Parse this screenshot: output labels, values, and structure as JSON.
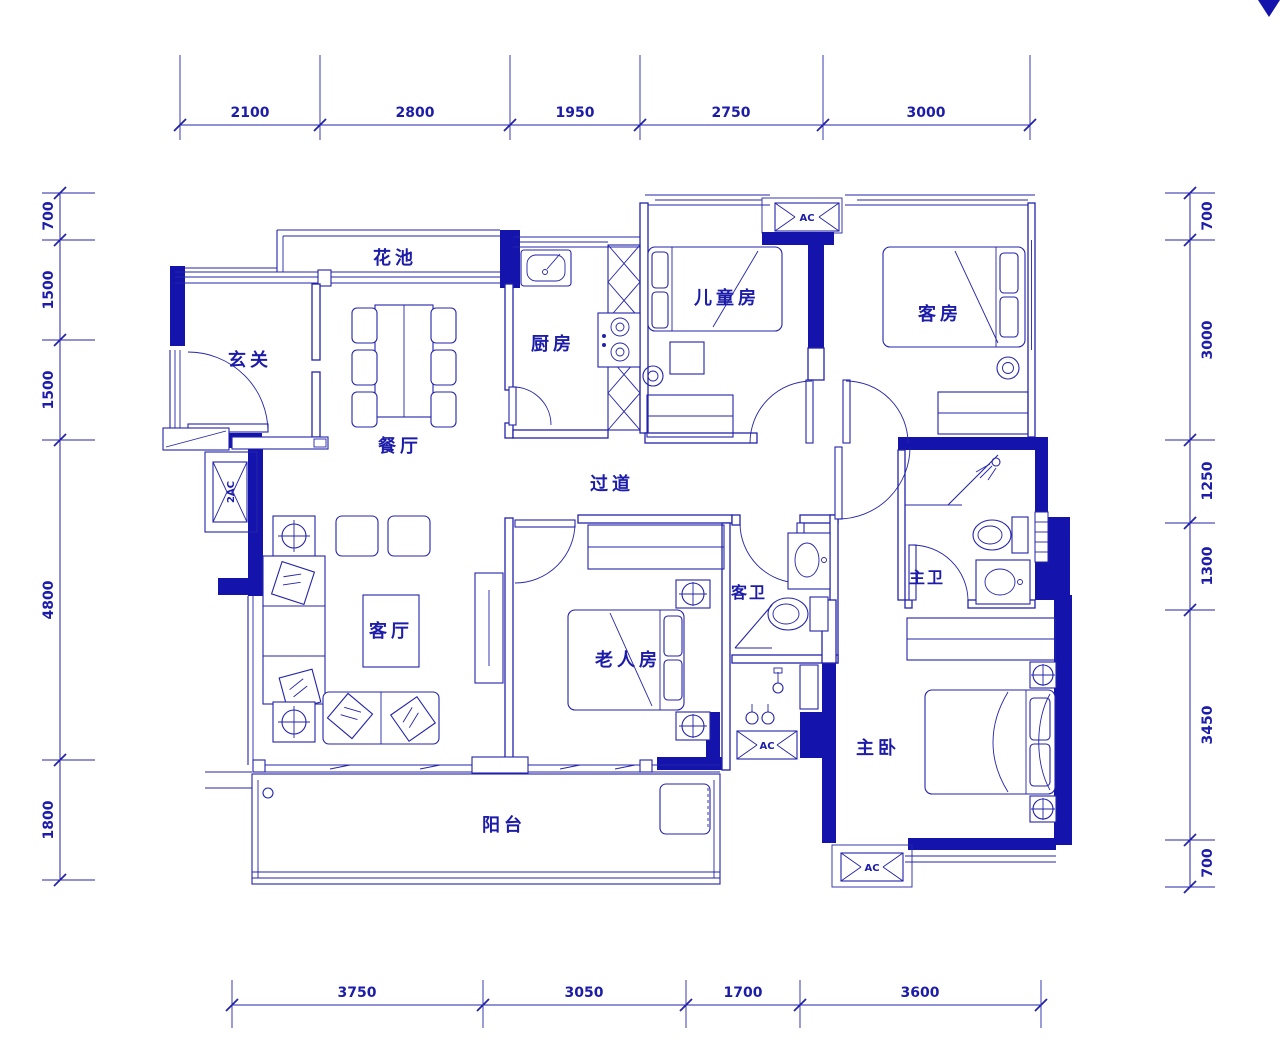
{
  "colors": {
    "line_blue": "#2323aa",
    "wall_fill": "#1414ac",
    "background": "#ffffff"
  },
  "rooms": {
    "flower_bed": {
      "label": "花池"
    },
    "foyer": {
      "label": "玄关"
    },
    "dining": {
      "label": "餐厅"
    },
    "kitchen": {
      "label": "厨房"
    },
    "kids_room": {
      "label": "儿童房"
    },
    "guest_room": {
      "label": "客房"
    },
    "corridor": {
      "label": "过道"
    },
    "living": {
      "label": "客厅"
    },
    "elder_room": {
      "label": "老人房"
    },
    "guest_bath": {
      "label": "客卫"
    },
    "master_bath": {
      "label": "主卫"
    },
    "master_bed": {
      "label": "主卧"
    },
    "balcony": {
      "label": "阳台"
    }
  },
  "ac_units": {
    "top": "AC",
    "left": "2AC",
    "middle": "AC",
    "bottom": "AC"
  },
  "dimensions": {
    "top": [
      "2100",
      "2800",
      "1950",
      "2750",
      "3000"
    ],
    "bottom": [
      "3750",
      "3050",
      "1700",
      "3600"
    ],
    "left": [
      "700",
      "1500",
      "1500",
      "4800",
      "1800"
    ],
    "right": [
      "700",
      "3000",
      "1250",
      "1300",
      "3450",
      "700"
    ]
  }
}
